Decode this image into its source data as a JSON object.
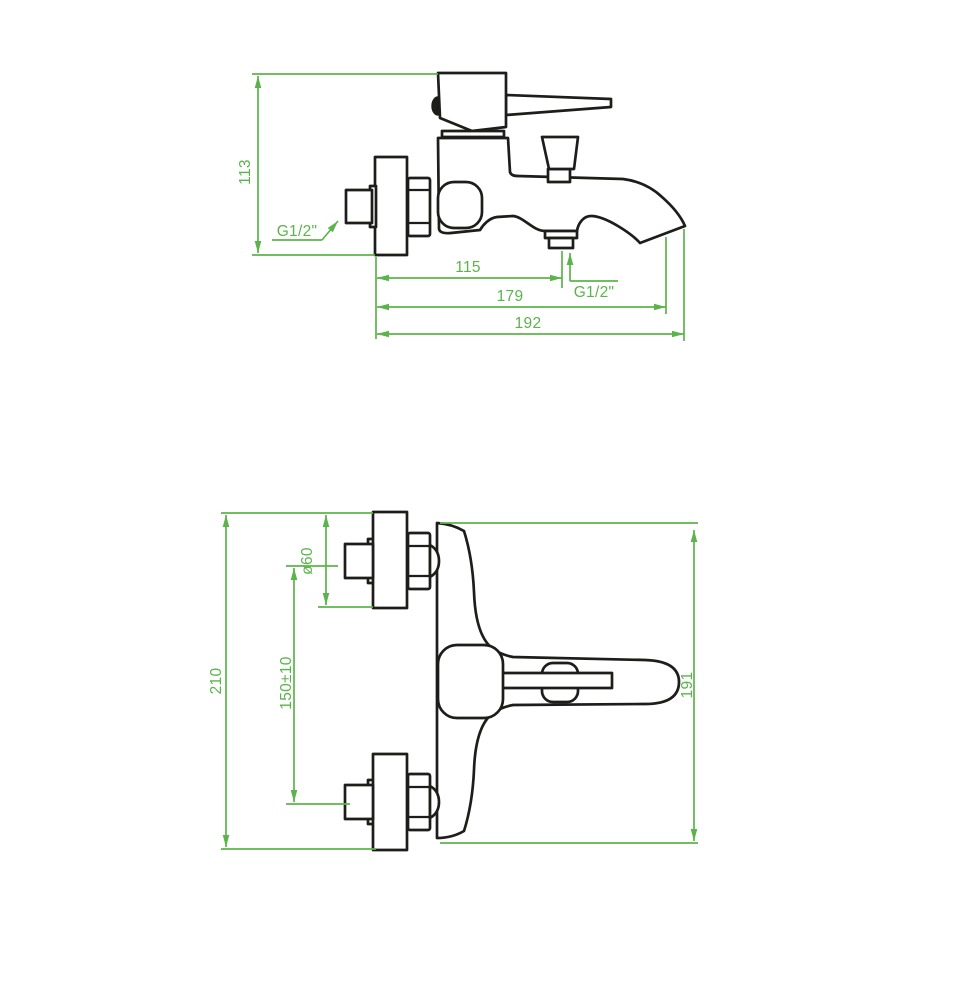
{
  "page": {
    "background": "#ffffff",
    "description": "Technical dimension drawing of a wall-mounted single-lever bath mixer tap, two views"
  },
  "colors": {
    "dimension_green": "#5bb44a",
    "outline_black": "#1d1d1b"
  },
  "views": {
    "side": {
      "label": "side-view-with-dimensions",
      "height_mm": "113",
      "wall_connection_thread": "G1/2\"",
      "shower_outlet_thread": "G1/2\"",
      "wall_to_shower_outlet_mm": "115",
      "wall_to_aerator_mm": "179",
      "wall_to_spout_tip_mm": "192"
    },
    "front": {
      "label": "plan-view-with-dimensions",
      "overall_length_mm": "210",
      "escutcheon_diameter_mm": "ø60",
      "connection_centers_mm": "150±10",
      "body_length_mm": "191"
    }
  }
}
